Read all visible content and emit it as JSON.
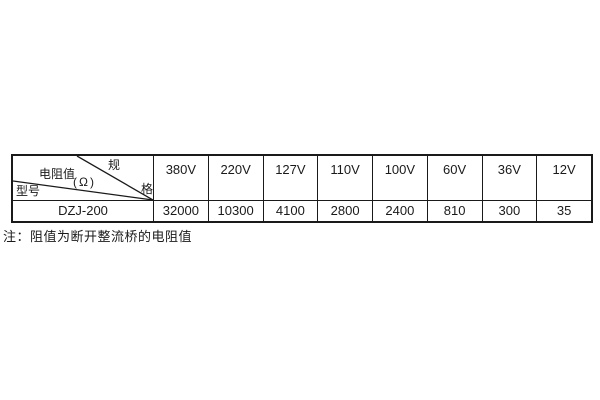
{
  "table": {
    "corner": {
      "spec_char_top": "规",
      "spec_char_bottom": "格",
      "spec_label_full": "规格",
      "resistance_label": "电阻值",
      "resistance_unit": "(Ω)",
      "model_label": "型号"
    },
    "columns": [
      "380V",
      "220V",
      "127V",
      "110V",
      "100V",
      "60V",
      "36V",
      "12V"
    ],
    "rows": [
      {
        "model": "DZJ-200",
        "values": [
          "32000",
          "10300",
          "4100",
          "2800",
          "2400",
          "810",
          "300",
          "35"
        ]
      }
    ]
  },
  "note": "注：阻值为断开整流桥的电阻值",
  "colors": {
    "border": "#1a1a1a",
    "text": "#1a1a1a",
    "background": "#ffffff"
  }
}
